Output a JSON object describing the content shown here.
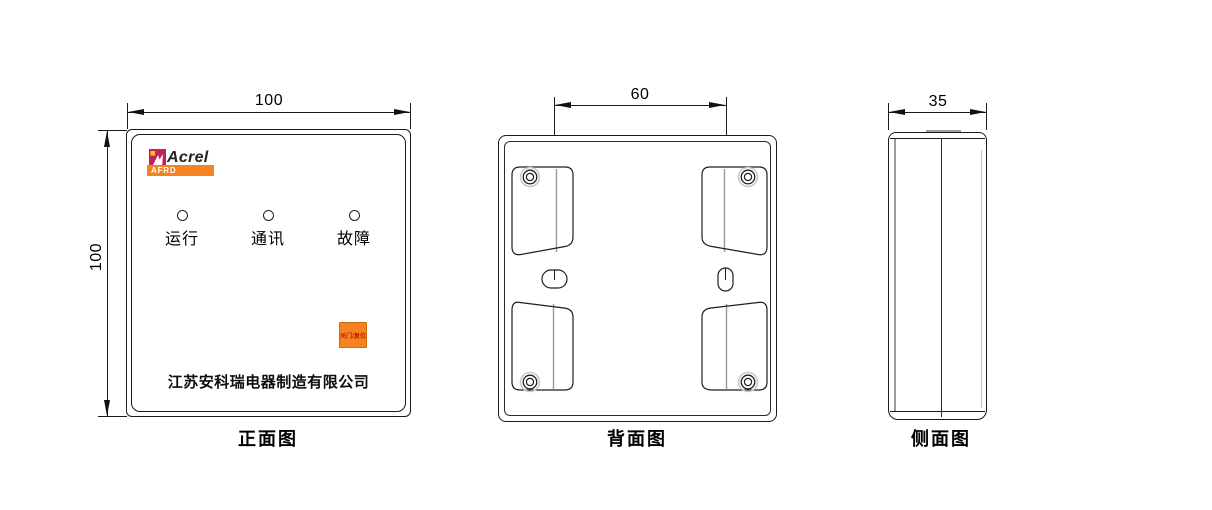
{
  "drawing": {
    "title": "AFRD device dimension drawing",
    "views": {
      "front": {
        "caption": "正面图",
        "width_dim": "100",
        "height_dim": "100",
        "brand": "Acrel",
        "model_badge": "AFRD",
        "indicators": [
          {
            "label": "运行"
          },
          {
            "label": "通讯"
          },
          {
            "label": "故障"
          }
        ],
        "button_label": "关门/复位",
        "company": "江苏安科瑞电器制造有限公司"
      },
      "back": {
        "caption": "背面图",
        "hole_spacing_dim": "60"
      },
      "side": {
        "caption": "侧面图",
        "depth_dim": "35"
      }
    },
    "colors": {
      "accent_orange": "#F5831F",
      "logo_magenta": "#C5205C",
      "logo_yellow": "#FFC20E",
      "button_text_red": "#C81A00",
      "line_black": "#1A1A1A"
    }
  }
}
